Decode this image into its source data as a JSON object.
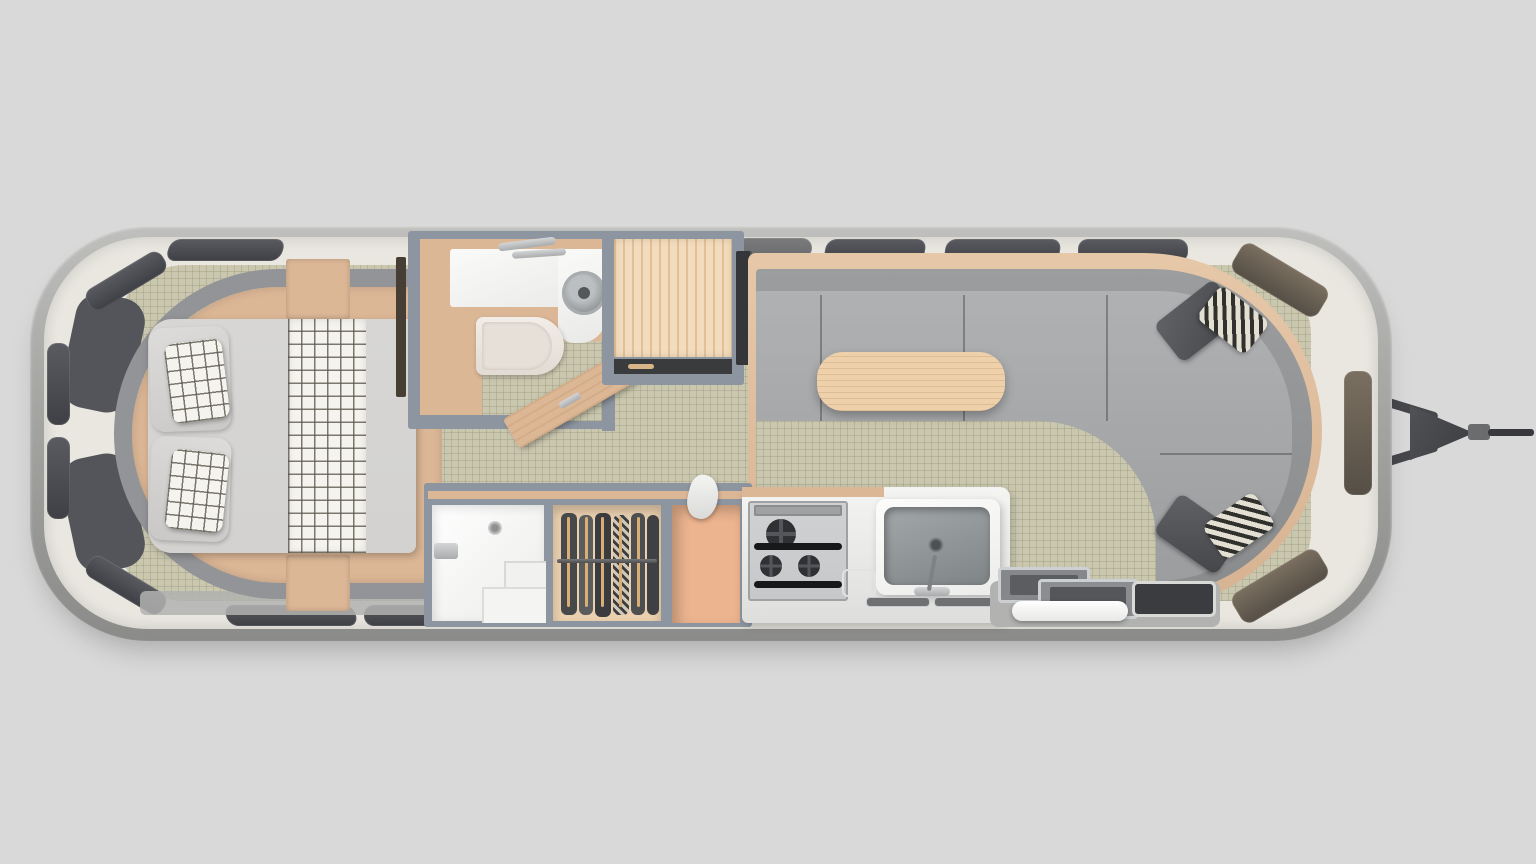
{
  "scene": {
    "description": "Top-down 3D rendered floor plan of a rounded travel trailer; rear bedroom on the left, front lounge and A-frame hitch on the right",
    "type": "floor-plan-render"
  },
  "colors": {
    "bg": "#d9d9d9",
    "wall_band": "#e9e7e0",
    "window_glass": "#3f4045",
    "window_tint_warm": "#564f46",
    "floor": "#cac7af",
    "partition": "#8d95a0",
    "upholstery_tan": "#dcb796",
    "wood_light": "#f3dcbd",
    "table_wood": "#eed0ab",
    "sofa_back": "#8a8c8e",
    "sofa_seat": "#a6a8aa",
    "bedding": "#d3d2d0",
    "plaid": "#f5f3ed",
    "fixture_white": "#f6f6f4",
    "stainless": "#c6c8ca",
    "burner_dark": "#232426",
    "pillow_dark": "#45464a",
    "pantry_peach": "#ecb48f",
    "hitch": "#46474a",
    "walkway": "#b2b2b0"
  },
  "floorplan": {
    "orientation": "hitch and front lounge on right, rear bedroom on left",
    "rooms": [
      {
        "id": "bedroom",
        "label": "Rear bedroom",
        "furniture": [
          "bed with gray duvet and plaid runner",
          "two plaid accent pillows",
          "wrap-around upholstered headboard",
          "tan side platforms and corner cabinets"
        ]
      },
      {
        "id": "bathroom",
        "label": "Bathroom",
        "furniture": [
          "L-shaped vanity counter",
          "round stainless sink",
          "faucet",
          "toilet",
          "open swing door"
        ]
      },
      {
        "id": "shower",
        "label": "Shower stall",
        "furniture": [
          "corner bench steps",
          "wall fixture",
          "drain"
        ]
      },
      {
        "id": "closet",
        "label": "Wardrobe closet",
        "furniture": [
          "closet rod",
          "hanging clothes"
        ]
      },
      {
        "id": "cabinet",
        "label": "Wood-top cabinet",
        "furniture": [
          "drawer"
        ]
      },
      {
        "id": "pantry",
        "label": "Open pantry cubby",
        "furniture": [
          "hanging towel"
        ]
      },
      {
        "id": "galley",
        "label": "Galley kitchen",
        "furniture": [
          "gas cooktop with black grates",
          "white counter",
          "rectangular sink with faucet",
          "under-counter vents"
        ]
      },
      {
        "id": "lounge",
        "label": "Front lounge",
        "furniture": [
          "U-shaped gray sofa",
          "wood table",
          "two dark throw pillows",
          "two striped throw pillows",
          "TV panel"
        ]
      },
      {
        "id": "entry",
        "label": "Entry with step and glass door"
      }
    ]
  },
  "exterior": {
    "shell_label": "Rounded aluminum shell",
    "window_label": "Window",
    "hitch_label": "A-frame tongue hitch with coupler"
  }
}
